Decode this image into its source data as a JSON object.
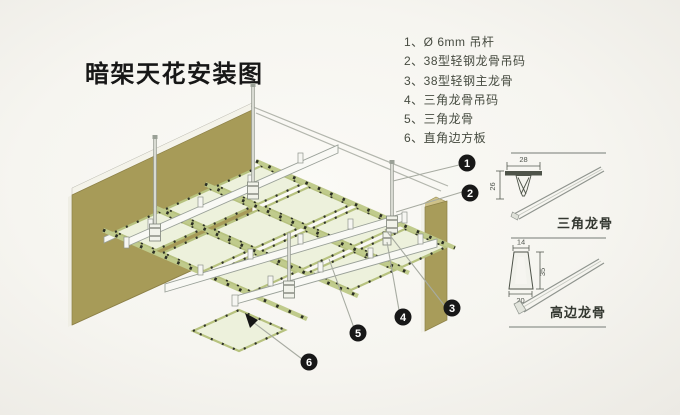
{
  "title": "暗架天花安装图",
  "legend": {
    "items": [
      {
        "label": "1、Ø 6mm 吊杆"
      },
      {
        "label": "2、38型轻钢龙骨吊码"
      },
      {
        "label": "3、38型轻钢主龙骨"
      },
      {
        "label": "4、三角龙骨吊码"
      },
      {
        "label": "5、三角龙骨"
      },
      {
        "label": "6、直角边方板"
      }
    ]
  },
  "balloons": [
    {
      "num": "1"
    },
    {
      "num": "2"
    },
    {
      "num": "3"
    },
    {
      "num": "4"
    },
    {
      "num": "5"
    },
    {
      "num": "6"
    }
  ],
  "details": {
    "triangle": {
      "label": "三角龙骨",
      "dim_width": "28",
      "dim_height": "26"
    },
    "high_edge": {
      "label": "高边龙骨",
      "dim_top": "14",
      "dim_height": "35",
      "dim_bottom": "20"
    }
  },
  "colors": {
    "wall": "#a79b58",
    "panel": "#edf1dc",
    "panel_edge": "#b7c27f",
    "keel_white": "#f9f9f5",
    "balloon": "#181818",
    "leader_line": "#a7aba1",
    "background": "#f6f5f0"
  }
}
